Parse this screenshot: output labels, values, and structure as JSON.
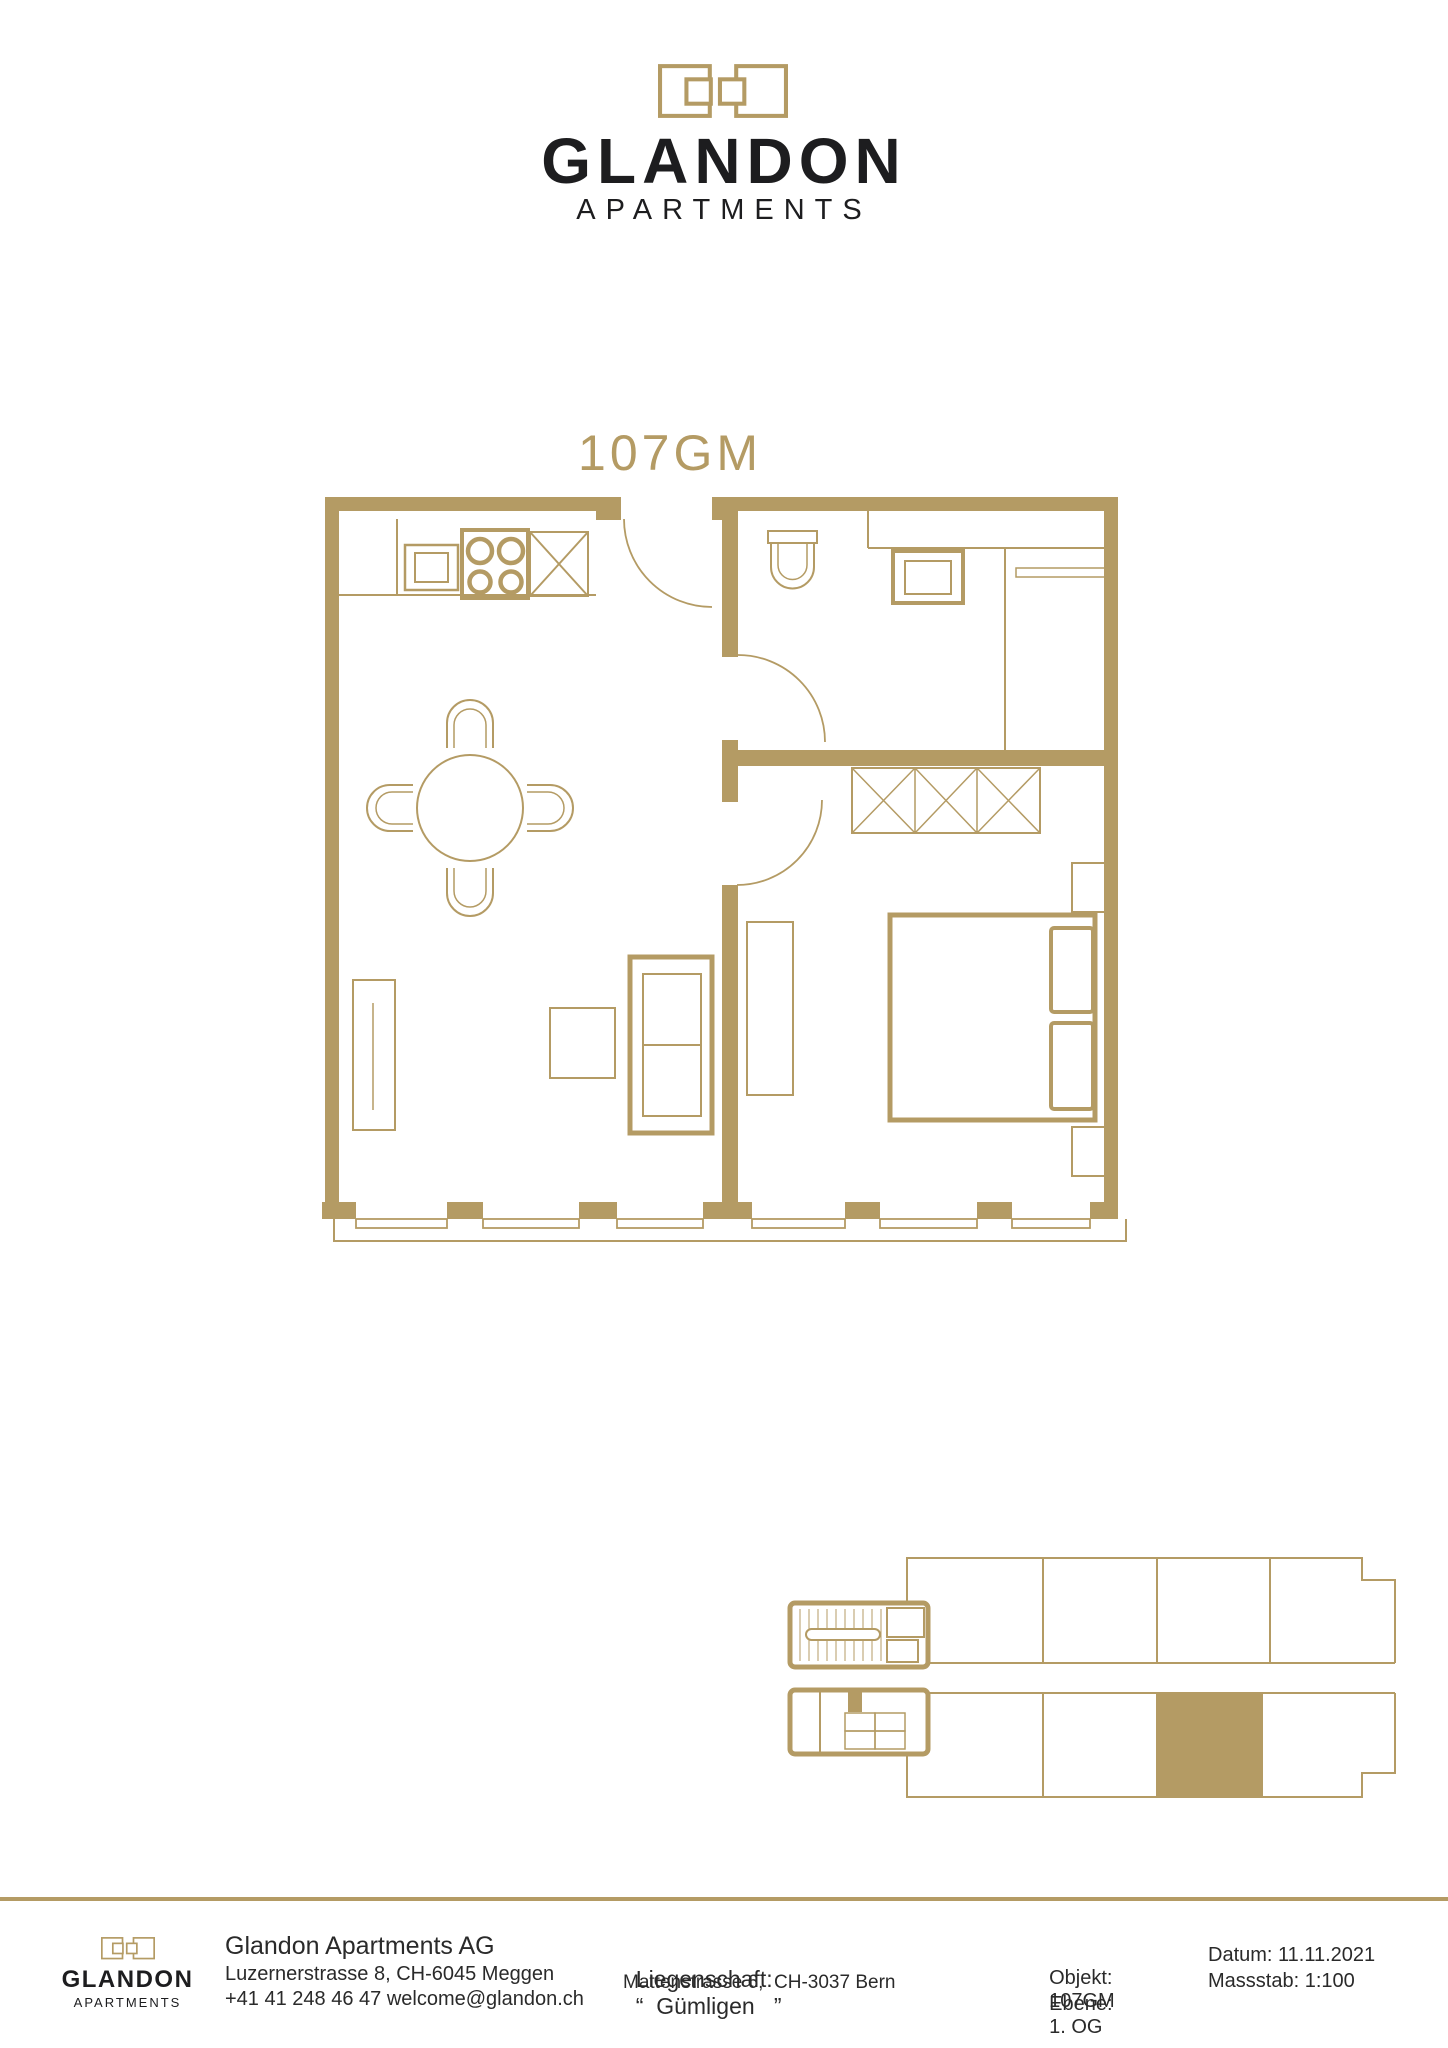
{
  "page": {
    "background": "#ffffff",
    "accent_gold": "#b49b64",
    "text_color": "#232323"
  },
  "header": {
    "brand": "GLANDON",
    "brand_sub": "APARTMENTS"
  },
  "floor_plan": {
    "title": "107GM"
  },
  "overview_plan": {
    "highlighted_unit": "107GM",
    "highlight_color": "#b49b64"
  },
  "footer": {
    "brand": "GLANDON",
    "brand_sub": "APARTMENTS",
    "company_name": "Glandon Apartments AG",
    "company_address": "Luzernerstrasse 8, CH-6045 Meggen",
    "company_contact": "+41 41 248 46 47 welcome@glandon.ch",
    "property_label": "Liegenschaft:",
    "property_value": "“  Gümligen   ”",
    "property_address": "Mattenstrasse 6,  CH-3037 Bern",
    "objekt_label": "Objekt:",
    "objekt_value": "107GM",
    "ebene_label": "Ebene: ",
    "ebene_value": "1. OG",
    "datum_label": "Datum:",
    "datum_value": "11.11.2021",
    "massstab_label": "Massstab:",
    "massstab_value": "1:100"
  }
}
